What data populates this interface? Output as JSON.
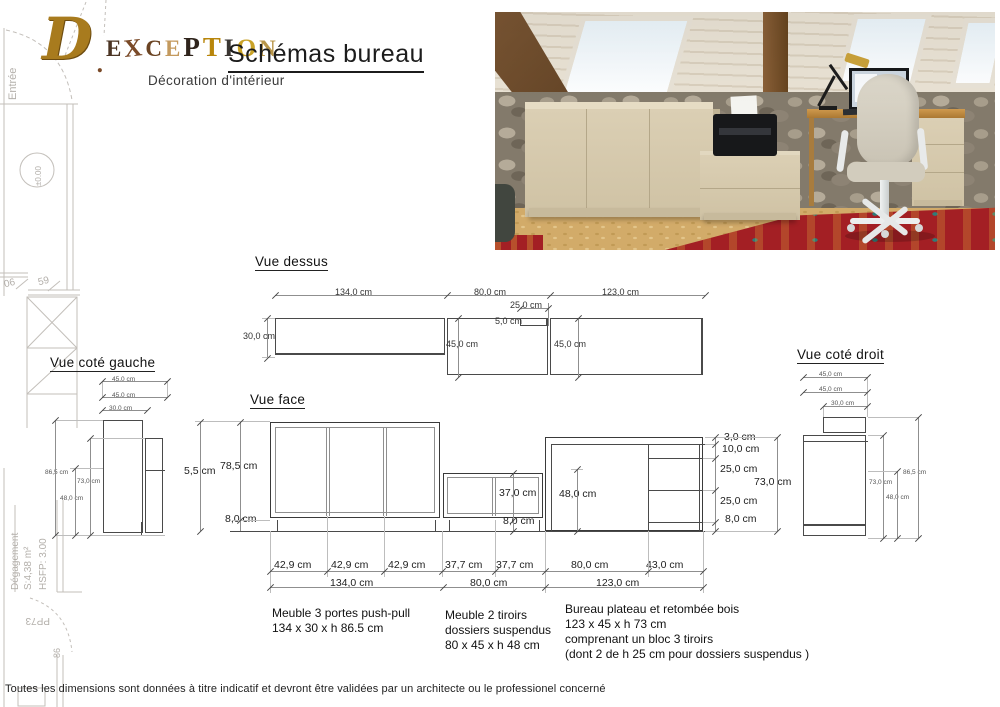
{
  "logo": {
    "d": "D",
    "dot": ".",
    "letters": [
      "E",
      "X",
      "C",
      "E",
      "P",
      "T",
      "I",
      "O",
      "N"
    ],
    "title": "Schémas bureau",
    "subtitle": "Décoration d'intérieur"
  },
  "plan": {
    "entree": "Entrée",
    "niveau": "±0.00",
    "c06": "06",
    "c59": "59",
    "degagement": "Dégagement",
    "surface": "S:4,38 m²",
    "hsfp": "HSFP: 3.00",
    "pp73": "PP73",
    "c86": "86"
  },
  "dessus": {
    "heading": "Vue dessus",
    "w134": "134,0 cm",
    "w80": "80,0 cm",
    "w123": "123,0 cm",
    "w25": "25,0 cm",
    "w5": "5,0 cm",
    "d30": "30,0 cm",
    "d45a": "45,0 cm",
    "d45b": "45,0 cm"
  },
  "face": {
    "heading": "Vue face",
    "h55": "5,5 cm",
    "h785": "78,5 cm",
    "h8a": "8,0 cm",
    "h37": "37,0 cm",
    "h8b": "8,0 cm",
    "h48": "48,0 cm",
    "h3": "3,0 cm",
    "h10": "10,0 cm",
    "h25a": "25,0 cm",
    "h25b": "25,0 cm",
    "h8c": "8,0 cm",
    "h73": "73,0 cm",
    "w429a": "42,9 cm",
    "w429b": "42,9 cm",
    "w429c": "42,9 cm",
    "w377a": "37,7 cm",
    "w377b": "37,7 cm",
    "w80top": "80,0 cm",
    "w43": "43,0 cm",
    "w134": "134,0 cm",
    "w80": "80,0 cm",
    "w123": "123,0 cm"
  },
  "gauche": {
    "heading": "Vue coté gauche",
    "d45a": "45,0 cm",
    "d45b": "45,0 cm",
    "d30": "30,0 cm",
    "h865": "86,5 cm",
    "h73": "73,0 cm",
    "h48": "48,0 cm"
  },
  "droit": {
    "heading": "Vue coté droit",
    "d45a": "45,0 cm",
    "d45b": "45,0 cm",
    "d30": "30,0 cm",
    "h865": "86,5 cm",
    "h73": "73,0 cm",
    "h48": "48,0 cm"
  },
  "notes": {
    "n1": [
      "Meuble 3 portes push-pull",
      "134 x 30 x h 86.5 cm"
    ],
    "n2": [
      "Meuble 2 tiroirs",
      "dossiers suspendus",
      "80 x 45 x h 48 cm"
    ],
    "n3": [
      "Bureau plateau et retombée bois",
      "123 x 45 x h 73 cm",
      "comprenant un bloc 3 tiroirs",
      "(dont 2 de h 25 cm pour dossiers suspendus )"
    ]
  },
  "footer": "Toutes les dimensions sont données à titre indicatif et devront être validées par un architecte ou le professionel concerné",
  "colors": {
    "line": "#4a4a4a",
    "dim": "#8f8f8f",
    "plan": "#bdb9b4",
    "beige": "#d5c9ae",
    "rug": "#a82025",
    "gold": "#b8860b"
  }
}
